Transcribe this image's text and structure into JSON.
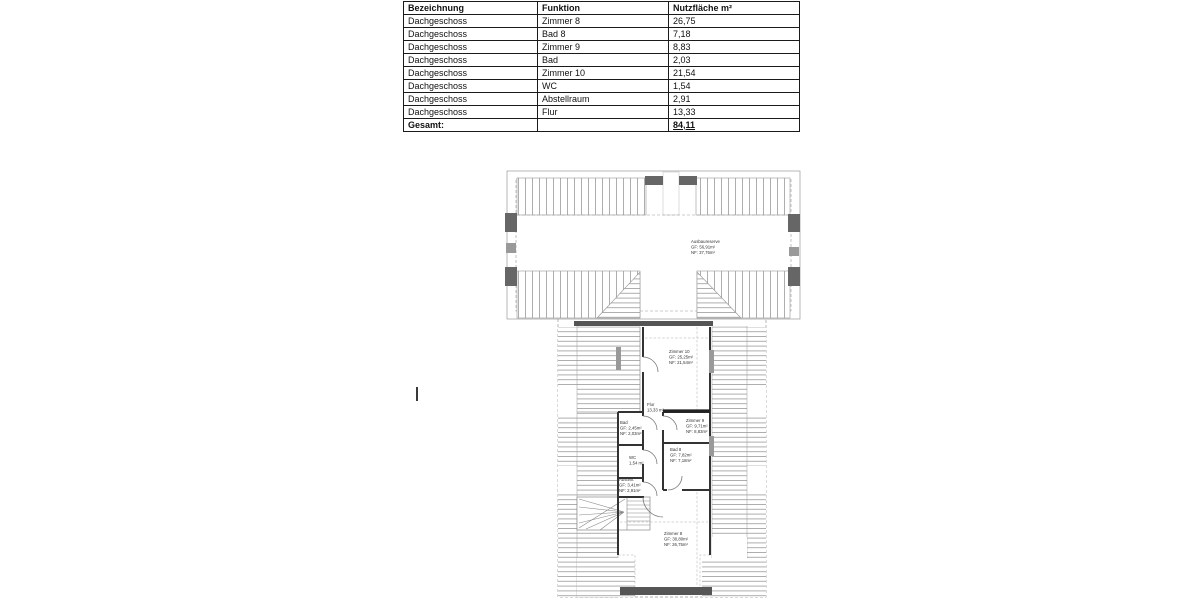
{
  "table": {
    "headers": [
      "Bezeichnung",
      "Funktion",
      "Nutzfläche m²"
    ],
    "rows": [
      [
        "Dachgeschoss",
        "Zimmer 8",
        "26,75"
      ],
      [
        "Dachgeschoss",
        "Bad 8",
        "7,18"
      ],
      [
        "Dachgeschoss",
        "Zimmer 9",
        "8,83"
      ],
      [
        "Dachgeschoss",
        "Bad",
        "2,03"
      ],
      [
        "Dachgeschoss",
        "Zimmer 10",
        "21,54"
      ],
      [
        "Dachgeschoss",
        "WC",
        "1,54"
      ],
      [
        "Dachgeschoss",
        "Abstellraum",
        "2,91"
      ],
      [
        "Dachgeschoss",
        "Flur",
        "13,33"
      ]
    ],
    "total_label": "Gesamt:",
    "total_value": "84,11"
  },
  "floorplan": {
    "reserve": {
      "line1": "Ausbaureserve",
      "line2": "GF: 56,91m²",
      "line3": "NF: 37,76m²"
    },
    "zimmer10": {
      "line1": "Zimmer 10",
      "line2": "GF: 25,25m²",
      "line3": "NF: 21,54m²"
    },
    "flur": {
      "line1": "Flur",
      "line2": "13,33 m²"
    },
    "bad": {
      "line1": "Bad",
      "line2": "GF: 2,45m²",
      "line3": "NF: 2,03m²"
    },
    "zimmer9": {
      "line1": "Zimmer 9",
      "line2": "GF: 9,71m²",
      "line3": "NF: 8,83m²"
    },
    "wc": {
      "line1": "WC",
      "line2": "1,54 m²"
    },
    "bad8": {
      "line1": "Bad 8",
      "line2": "GF: 7,82m²",
      "line3": "NF: 7,18m²"
    },
    "abstell": {
      "line1": "Abstellr.",
      "line2": "GF: 3,41m²",
      "line3": "NF: 2,91m²"
    },
    "zimmer8": {
      "line1": "Zimmer 8",
      "line2": "GF: 30,80m²",
      "line3": "NF: 26,75m²"
    }
  }
}
